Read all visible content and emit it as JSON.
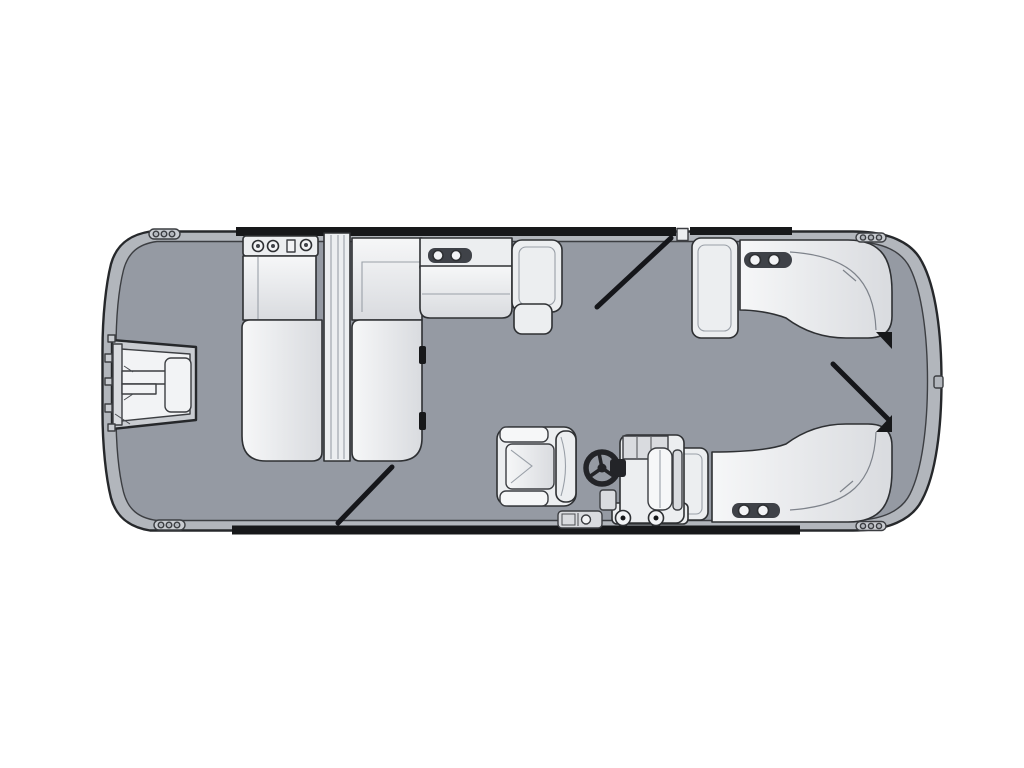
{
  "diagram": {
    "type": "floorplan",
    "subject": "pontoon-boat-deck-layout-top-view",
    "orientation": "horizontal, boarding gate at left, rounded walk-through end at right",
    "components": [
      {
        "name": "hull-fence",
        "label": "pontoon hull / fence rail outline"
      },
      {
        "name": "deck",
        "label": "gray vinyl deck floor"
      },
      {
        "name": "boarding-gate-ladder",
        "label": "left-end boarding gate with ladder and door panel"
      },
      {
        "name": "forward-chaise-left",
        "label": "forward chaise lounger (left of divider)"
      },
      {
        "name": "forward-chaise-right",
        "label": "forward chaise lounger (right of divider)"
      },
      {
        "name": "chaise-divider",
        "label": "center armrest divider between chaise loungers"
      },
      {
        "name": "chaise-cupholder-console",
        "label": "cup-holder console on chaise backrest"
      },
      {
        "name": "side-bench",
        "label": "top-side bench seat with armrest"
      },
      {
        "name": "wraparound-lounge-top",
        "label": "curved wrap-around lounge, top rear corner"
      },
      {
        "name": "wraparound-lounge-bottom",
        "label": "curved wrap-around lounge, bottom rear corner"
      },
      {
        "name": "captain-chair",
        "label": "swivel captain chair"
      },
      {
        "name": "steering-wheel",
        "label": "helm steering wheel"
      },
      {
        "name": "helm-console",
        "label": "helm console with windscreen and base wheels"
      },
      {
        "name": "transom-gear",
        "label": "small deck hardware beside console base"
      },
      {
        "name": "gate-swing-markers",
        "label": "three diagonal gate-swing indicator lines"
      },
      {
        "name": "cleats",
        "label": "four mooring cleats on the rails"
      },
      {
        "name": "cup-holders",
        "label": "recessed drink holders on seat tops"
      }
    ],
    "counts": {
      "gate_swing_markers": 3,
      "cleats": 4,
      "chaise_loungers": 2,
      "wraparound_lounges": 2
    }
  },
  "colors": {
    "background": "#ffffff",
    "hull_rail": "#b2b6bc",
    "deck": "#959aa3",
    "trim_black": "#17181a",
    "furniture": "#eceef0",
    "furniture_bright": "#f6f7f8",
    "furniture_shade": "#d9dbdf",
    "frame_gray": "#c9ccd1",
    "panel_white": "#f2f3f5",
    "recess_dark": "#3f4248",
    "wheel_black": "#232428",
    "outline": "#2e3033"
  }
}
